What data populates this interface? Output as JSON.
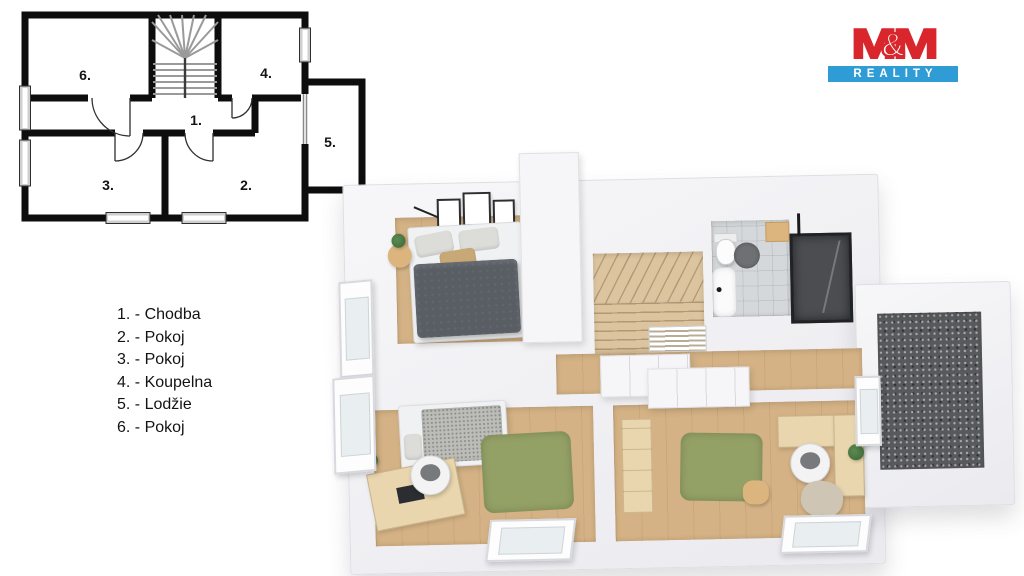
{
  "logo": {
    "m_left": "M",
    "ampersand": "&",
    "m_right": "M",
    "subtitle": "REALITY"
  },
  "legend": {
    "items": [
      {
        "label": "1. - Chodba"
      },
      {
        "label": "2. - Pokoj"
      },
      {
        "label": "3. - Pokoj"
      },
      {
        "label": "4. - Koupelna"
      },
      {
        "label": "5. - Lodžie"
      },
      {
        "label": "6. - Pokoj"
      }
    ]
  },
  "plan2d": {
    "room_labels": {
      "hallway": "1.",
      "room2": "2.",
      "room3": "3.",
      "bathroom": "4.",
      "loggia": "5.",
      "room6": "6."
    }
  },
  "colors": {
    "logo_red": "#d8262c",
    "logo_blue": "#2f9cd6",
    "plan_wall": "#0d0d0d",
    "wood": "#d4b285",
    "wood_light": "#e9d6ae",
    "stairs_wood": "#dbc49e",
    "rug_green": "#94a166",
    "duvet": "#595e64",
    "blanket": "#bcbcb8",
    "balcony_floor": "#58595c",
    "tile": "#d5d8da",
    "wall_white": "#f4f4f6"
  }
}
